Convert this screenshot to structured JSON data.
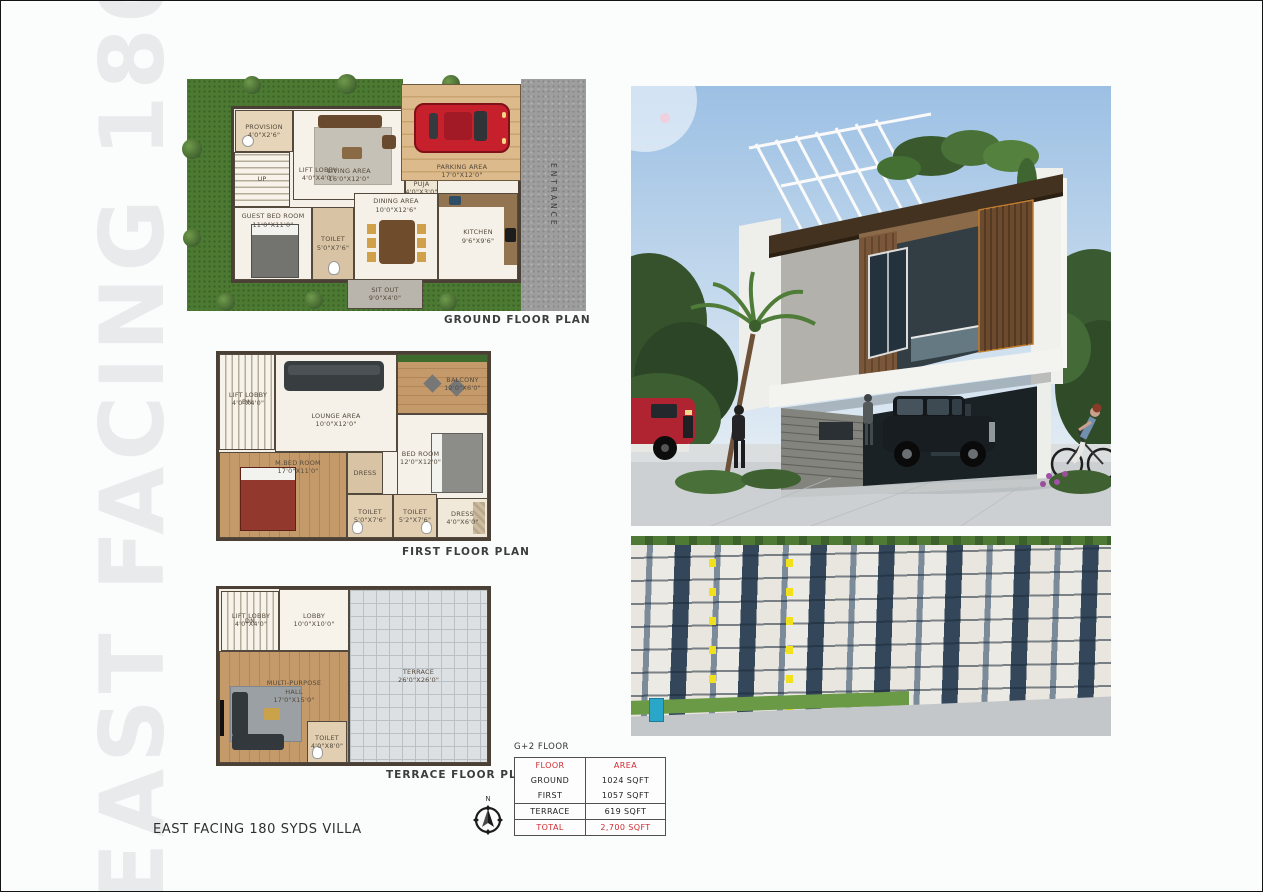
{
  "watermark": "EAST FACING 180 SYDS",
  "footer": {
    "title": "EAST FACING 180 SYDS VILLA",
    "compass_north": "N"
  },
  "colors": {
    "accent_red": "#cf2b30",
    "plan_green": "#4d7a33",
    "road_gray": "#9d9d9d",
    "aerial_navy": "#3c4f63",
    "aerial_yellow": "#f0e11c",
    "wood": "#7a573a",
    "sky": "#9cc0e4"
  },
  "plans": {
    "ground": {
      "caption": "GROUND FLOOR PLAN",
      "entrance": "ENTRANCE",
      "up": "UP",
      "rooms": {
        "provision": "PROVISION\n4'0\"x2'6\"",
        "lift_lobby": "LIFT LOBBY\n4'0\"x4'0\"",
        "living": "LIVING AREA\n16'0\"x12'0\"",
        "guest_bed": "GUEST BED ROOM\n11'0\"x11'0\"",
        "toilet": "TOILET\n5'0\"x7'6\"",
        "dining": "DINING AREA\n10'0\"x12'6\"",
        "kitchen": "KITCHEN\n9'6\"x9'6\"",
        "puja": "PUJA\n4'0\"x3'0\"",
        "sitout": "SIT OUT\n9'0\"x4'0\"",
        "parking": "PARKING AREA\n17'0\"x12'0\""
      }
    },
    "first": {
      "caption": "FIRST FLOOR PLAN",
      "dn": "DN",
      "rooms": {
        "lift_lobby": "LIFT LOBBY\n4'0\"x4'0\"",
        "lounge": "LOUNGE AREA\n10'0\"x12'0\"",
        "balcony": "BALCONY\n12'0\"x6'0\"",
        "bed": "BED ROOM\n12'0\"x12'0\"",
        "mbed": "M.BED ROOM\n17'0\"x11'0\"",
        "dress": "DRESS",
        "toilet1": "TOILET\n5'0\"x7'6\"",
        "toilet2": "TOILET\n5'2\"x7'6\"",
        "dress2": "DRESS\n4'0\"x6'0\""
      }
    },
    "terrace": {
      "caption": "TERRACE FLOOR PLAN",
      "dn": "DN",
      "rooms": {
        "lift_lobby": "LIFT LOBBY\n4'0\"x4'0\"",
        "lobby": "LOBBY\n10'0\"x10'0\"",
        "hall": "MULTI-PURPOSE\nHALL\n17'0\"x15'0\"",
        "toilet": "TOILET\n4'0\"x8'0\"",
        "terrace": "TERRACE\n26'0\"x26'0\""
      }
    }
  },
  "area_table": {
    "title": "G+2 FLOOR",
    "col_floor": "FLOOR",
    "col_area": "AREA",
    "rows": [
      {
        "floor": "GROUND",
        "area": "1024 SQFT"
      },
      {
        "floor": "FIRST",
        "area": "1057 SQFT"
      },
      {
        "floor": "TERRACE",
        "area": "619 SQFT"
      }
    ],
    "total_label": "TOTAL",
    "total_area": "2,700 SQFT"
  }
}
